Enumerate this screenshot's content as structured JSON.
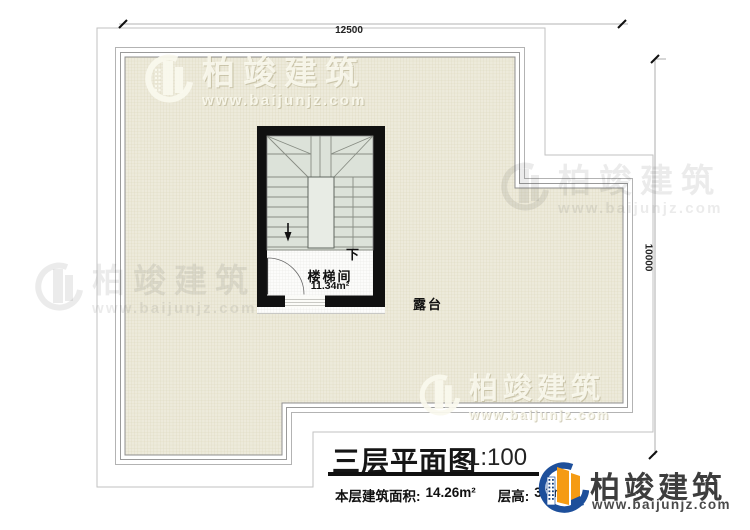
{
  "dimensions": {
    "width_label": "12500",
    "height_label": "10000"
  },
  "stairwell": {
    "name_label": "楼梯间",
    "area_label": "11.34m²",
    "direction_label": "下"
  },
  "terrace": {
    "label": "露台"
  },
  "title_block": {
    "title": "三层平面图",
    "scale": "1:100",
    "floor_area_label": "本层建筑面积:",
    "floor_area_value": "14.26m²",
    "floor_height_label": "层高:",
    "floor_height_value": "3.3m"
  },
  "brand": {
    "name": "柏竣建筑",
    "site": "www.baijunjz.com"
  }
}
